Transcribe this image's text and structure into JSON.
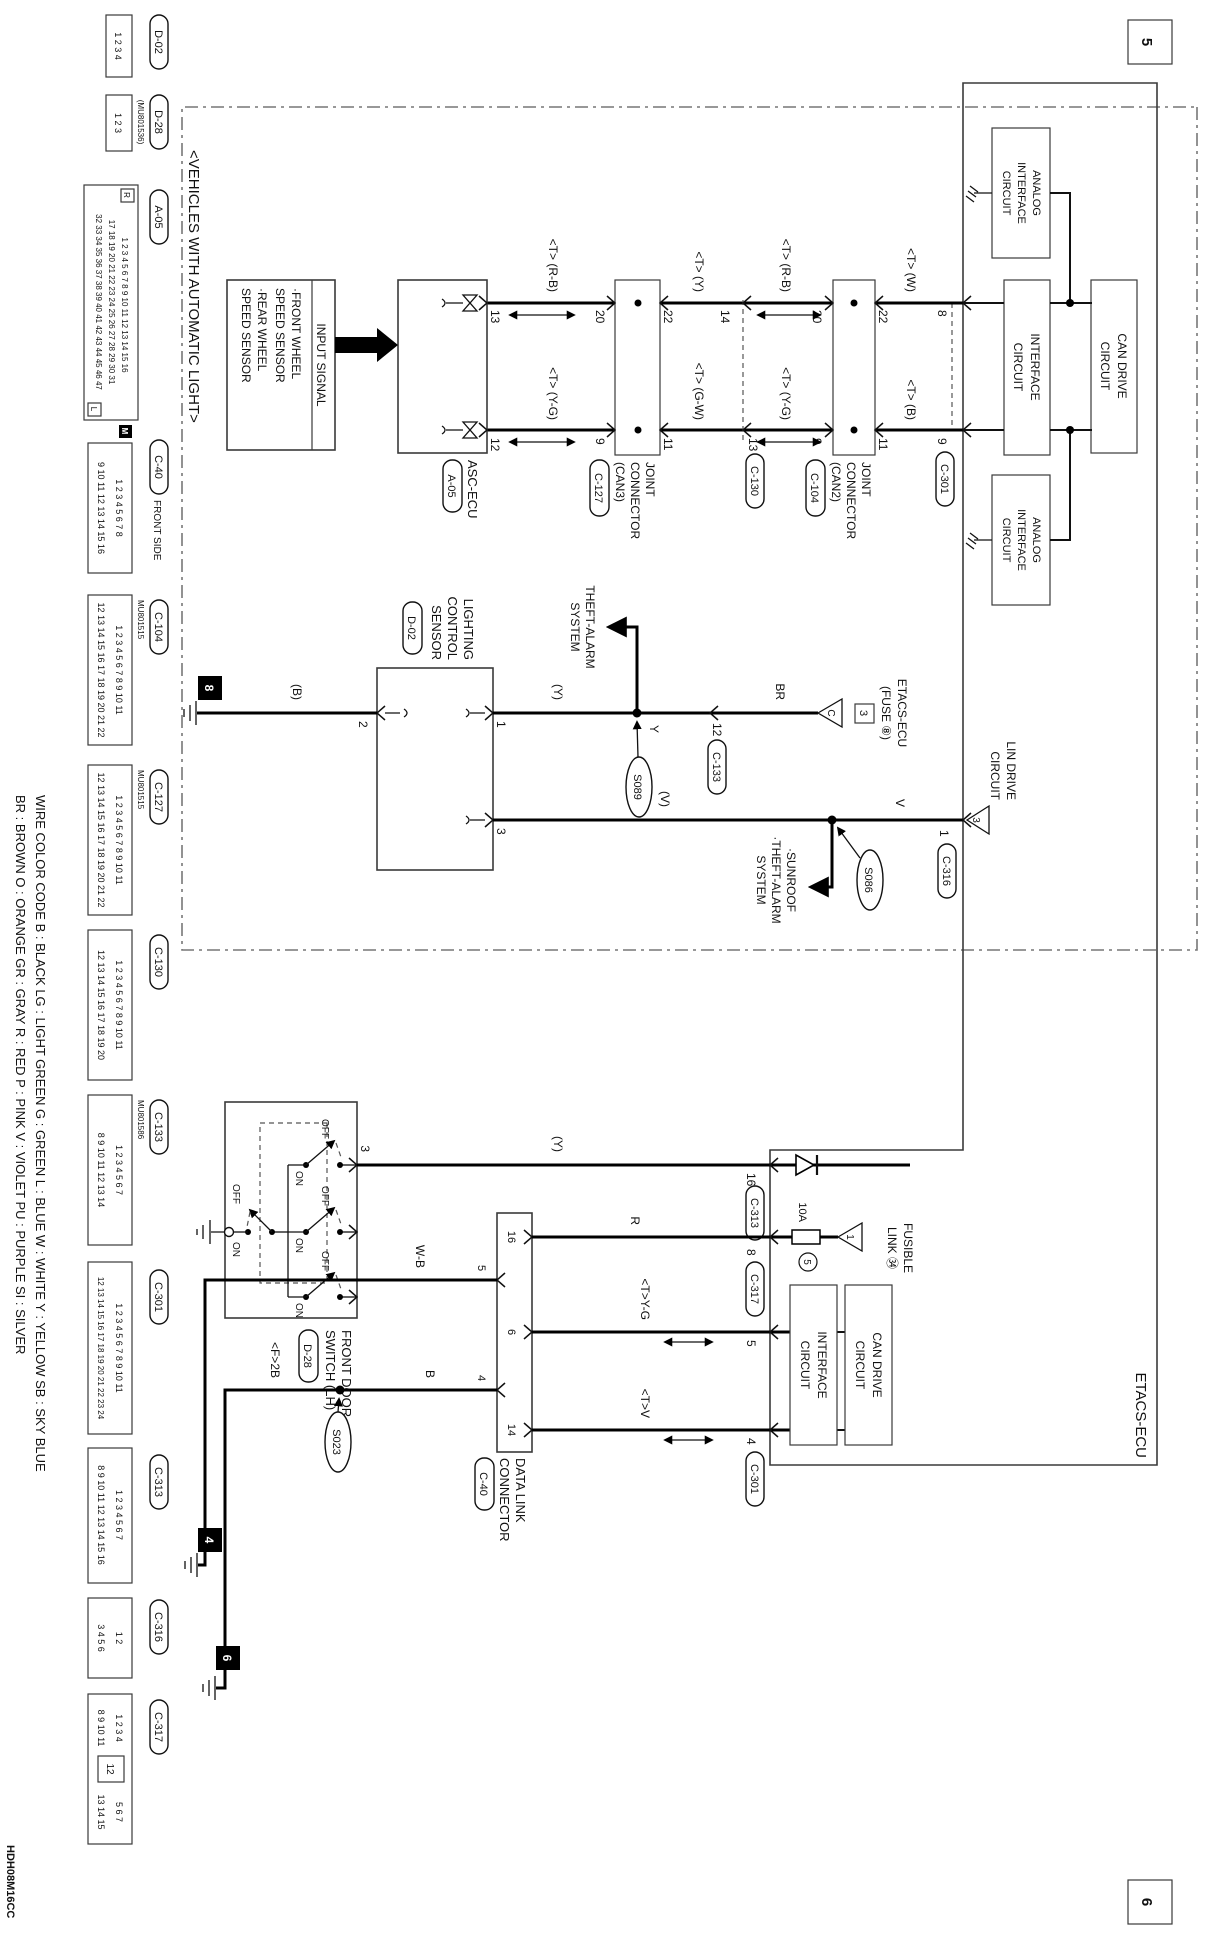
{
  "sheet": {
    "left": "5",
    "right": "6"
  },
  "section_label": "<VEHICLES WITH AUTOMATIC LIGHT>",
  "doc_code": "HDH08M16CC",
  "legend": [
    "WIRE COLOR CODE   B : BLACK   LG : LIGHT GREEN   G : GREEN   L : BLUE   W : WHITE   Y : YELLOW   SB : SKY BLUE",
    "BR : BROWN   O : ORANGE   GR : GRAY   R : RED   P : PINK   V : VIOLET   PU : PURPLE   SI : SILVER"
  ],
  "etacs": {
    "name": "ETACS-ECU",
    "analog": [
      "ANALOG",
      "INTERFACE",
      "CIRCUIT"
    ],
    "interface": [
      "INTERFACE",
      "CIRCUIT"
    ],
    "can_drive": [
      "CAN DRIVE",
      "CIRCUIT"
    ],
    "lin": [
      "LIN DRIVE",
      "CIRCUIT"
    ]
  },
  "asc": {
    "name": "ASC-ECU",
    "badge": "A-05"
  },
  "input": {
    "title": "INPUT SIGNAL",
    "lines": [
      "·FRONT WHEEL",
      "  SPEED SENSOR",
      "·REAR WHEEL",
      "  SPEED SENSOR"
    ]
  },
  "jc_can3": {
    "lines": [
      "JOINT",
      "CONNECTOR",
      "(CAN3)"
    ],
    "badge": "C-127"
  },
  "jc_can2": {
    "lines": [
      "JOINT",
      "CONNECTOR",
      "(CAN2)"
    ],
    "badge": "C-104"
  },
  "sensor": {
    "lines": [
      "LIGHTING",
      "CONTROL",
      "SENSOR"
    ],
    "badge": "D-02"
  },
  "door": {
    "lines": [
      "FRONT DOOR",
      "SWITCH (LH)"
    ],
    "badge": "D-28",
    "off": "OFF",
    "on": "ON"
  },
  "dlc": {
    "lines": [
      "DATA LINK",
      "CONNECTOR"
    ],
    "badge": "C-40"
  },
  "theft": [
    "THEFT-ALARM",
    "SYSTEM"
  ],
  "sunroof": [
    "·SUNROOF",
    "·THEFT-ALARM",
    "SYSTEM"
  ],
  "fuse8": {
    "lines": [
      "ETACS-ECU",
      "(FUSE ⑧)"
    ],
    "tri": "C",
    "ref": "3"
  },
  "lin_ref": "3",
  "fusible": {
    "lines": [
      "FUSIBLE",
      "LINK ㉞"
    ],
    "amp": "10A",
    "no": "5",
    "tri": "1"
  },
  "splice": {
    "s089": "S089",
    "s086": "S086",
    "s023": "S023"
  },
  "gnd": {
    "g8": "8",
    "g4": "4",
    "g6": "6"
  },
  "wire": {
    "tw": "<T> (W)",
    "tb": "<T> (B)",
    "trb": "<T> (R-B)",
    "tyg": "<T> (Y-G)",
    "ty": "<T> (Y)",
    "tgw": "<T> (G-W)",
    "y_par": "(Y)",
    "y": "Y",
    "br": "BR",
    "b_par": "(B)",
    "v_par": "(V)",
    "v": "V",
    "r": "R",
    "wb": "W-B",
    "b": "B",
    "f2b": "<F>2B",
    "tyg2": "<T>Y-G",
    "tv": "<T>V"
  },
  "pin": {
    "p1": "1",
    "p2": "2",
    "p3": "3",
    "p4": "4",
    "p5": "5",
    "p6": "6",
    "p8": "8",
    "p9": "9",
    "p11": "11",
    "p12": "12",
    "p13": "13",
    "p14": "14",
    "p16": "16",
    "p20": "20",
    "p22": "22"
  },
  "badge": {
    "c301": "C-301",
    "c316": "C-316",
    "c313": "C-313",
    "c317": "C-317",
    "c130": "C-130",
    "c133": "C-133"
  },
  "conn": {
    "d02": {
      "badge": "D-02",
      "rows": [
        "1 2 3 4"
      ]
    },
    "d28": {
      "badge": "D-28",
      "sub": "(MU801536)",
      "rows": [
        "1 2 3"
      ]
    },
    "a05": {
      "badge": "A-05",
      "rows": [
        "1 2 3 4 5 6 7 8 9 10 11 12 13 14 15 16",
        "17 18 19 20 21 22 23 24 25 26 27 28 29 30 31",
        "32 33 34 35 36 37 38 39 40 41 42 43 44 45 46 47"
      ],
      "r": "R",
      "l": "L"
    },
    "c40": {
      "badge": "C-40",
      "sub": "FRONT SIDE",
      "m": "M",
      "rows": [
        "1 2 3 4 5 6 7 8",
        "9 10 11 12 13 14 15 16"
      ]
    },
    "c104": {
      "badge": "C-104",
      "sub": "MU801515",
      "rows": [
        "1 2 3 4 5 6 7 8 9 10 11",
        "12 13 14 15 16 17 18 19 20 21 22"
      ]
    },
    "c127": {
      "badge": "C-127",
      "sub": "MU801515",
      "rows": [
        "1 2 3 4 5 6 7 8 9 10 11",
        "12 13 14 15 16 17 18 19 20 21 22"
      ]
    },
    "c130": {
      "badge": "C-130",
      "rows": [
        "1 2 3 4 5 6 7 8 9 10 11",
        "12 13 14 15 16 17 18 19 20"
      ]
    },
    "c133": {
      "badge": "C-133",
      "sub": "MU801586",
      "rows": [
        "1 2 3 4 5 6 7",
        "8 9 10 11 12 13 14"
      ]
    },
    "c301": {
      "badge": "C-301",
      "rows": [
        "1 2 3 4 5 6 7 8 9 10 11",
        "12 13 14 15 16 17 18 19 20 21 22 23 24"
      ]
    },
    "c313": {
      "badge": "C-313",
      "rows": [
        "1 2 3 4 5 6 7",
        "8 9 10 11 12 13 14 15 16"
      ]
    },
    "c316": {
      "badge": "C-316",
      "rows": [
        "1 2",
        "3 4 5 6"
      ]
    },
    "c317": {
      "badge": "C-317",
      "rowsL": [
        "1 2 3 4",
        "8 9 10 11"
      ],
      "center": "12",
      "rowsR": [
        "5 6 7",
        "13 14 15"
      ]
    }
  }
}
